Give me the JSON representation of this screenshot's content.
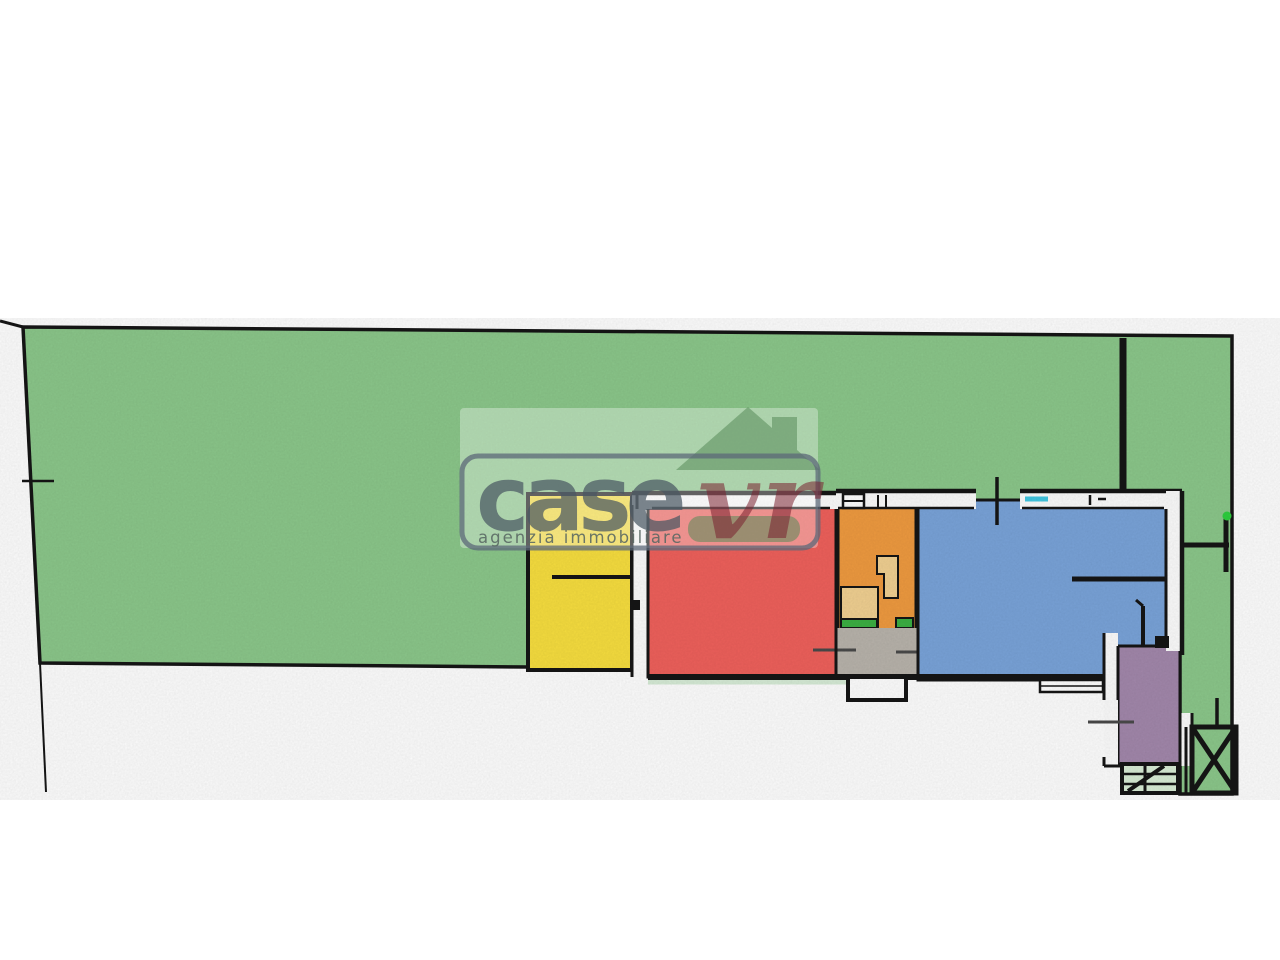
{
  "watermark": {
    "brand_primary": "case",
    "brand_secondary": "vr",
    "tagline": "agenzia immobiliare"
  },
  "plan": {
    "kind": "floor-plan",
    "areas": [
      {
        "id": "garden",
        "color_name": "green"
      },
      {
        "id": "yellow-room",
        "color_name": "yellow"
      },
      {
        "id": "red-room",
        "color_name": "red"
      },
      {
        "id": "orange-room",
        "color_name": "orange"
      },
      {
        "id": "blue-room",
        "color_name": "blue"
      },
      {
        "id": "purple-room",
        "color_name": "purple"
      },
      {
        "id": "hall-area",
        "color_name": "gray"
      }
    ]
  },
  "colors": {
    "garden": "#8cc88b",
    "yellow_room": "#f8df3f",
    "red_room": "#f0615c",
    "orange_room": "#f09b40",
    "fixture_tan": "#f2d192",
    "blue_room": "#7aa4da",
    "purple_room": "#a388ac",
    "hall_gray": "#b9b4ac",
    "threshold_green": "#3cb043",
    "stairs_green": "#d9eed6",
    "window_cyan": "#41c7e2",
    "wall_white": "#fdfdfd",
    "line_black": "#161616",
    "marker_green": "#2ed03e",
    "watermark_band": "rgba(255,255,255,0.33)",
    "logo_house_green": "rgba(88,138,90,0.55)",
    "logo_border": "rgba(92,104,120,0.75)",
    "logo_case_gray": "rgba(74,88,98,0.72)",
    "logo_vr_maroon": "rgba(122,32,48,0.55)",
    "logo_tagline_gray": "rgba(88,102,98,0.88)"
  }
}
